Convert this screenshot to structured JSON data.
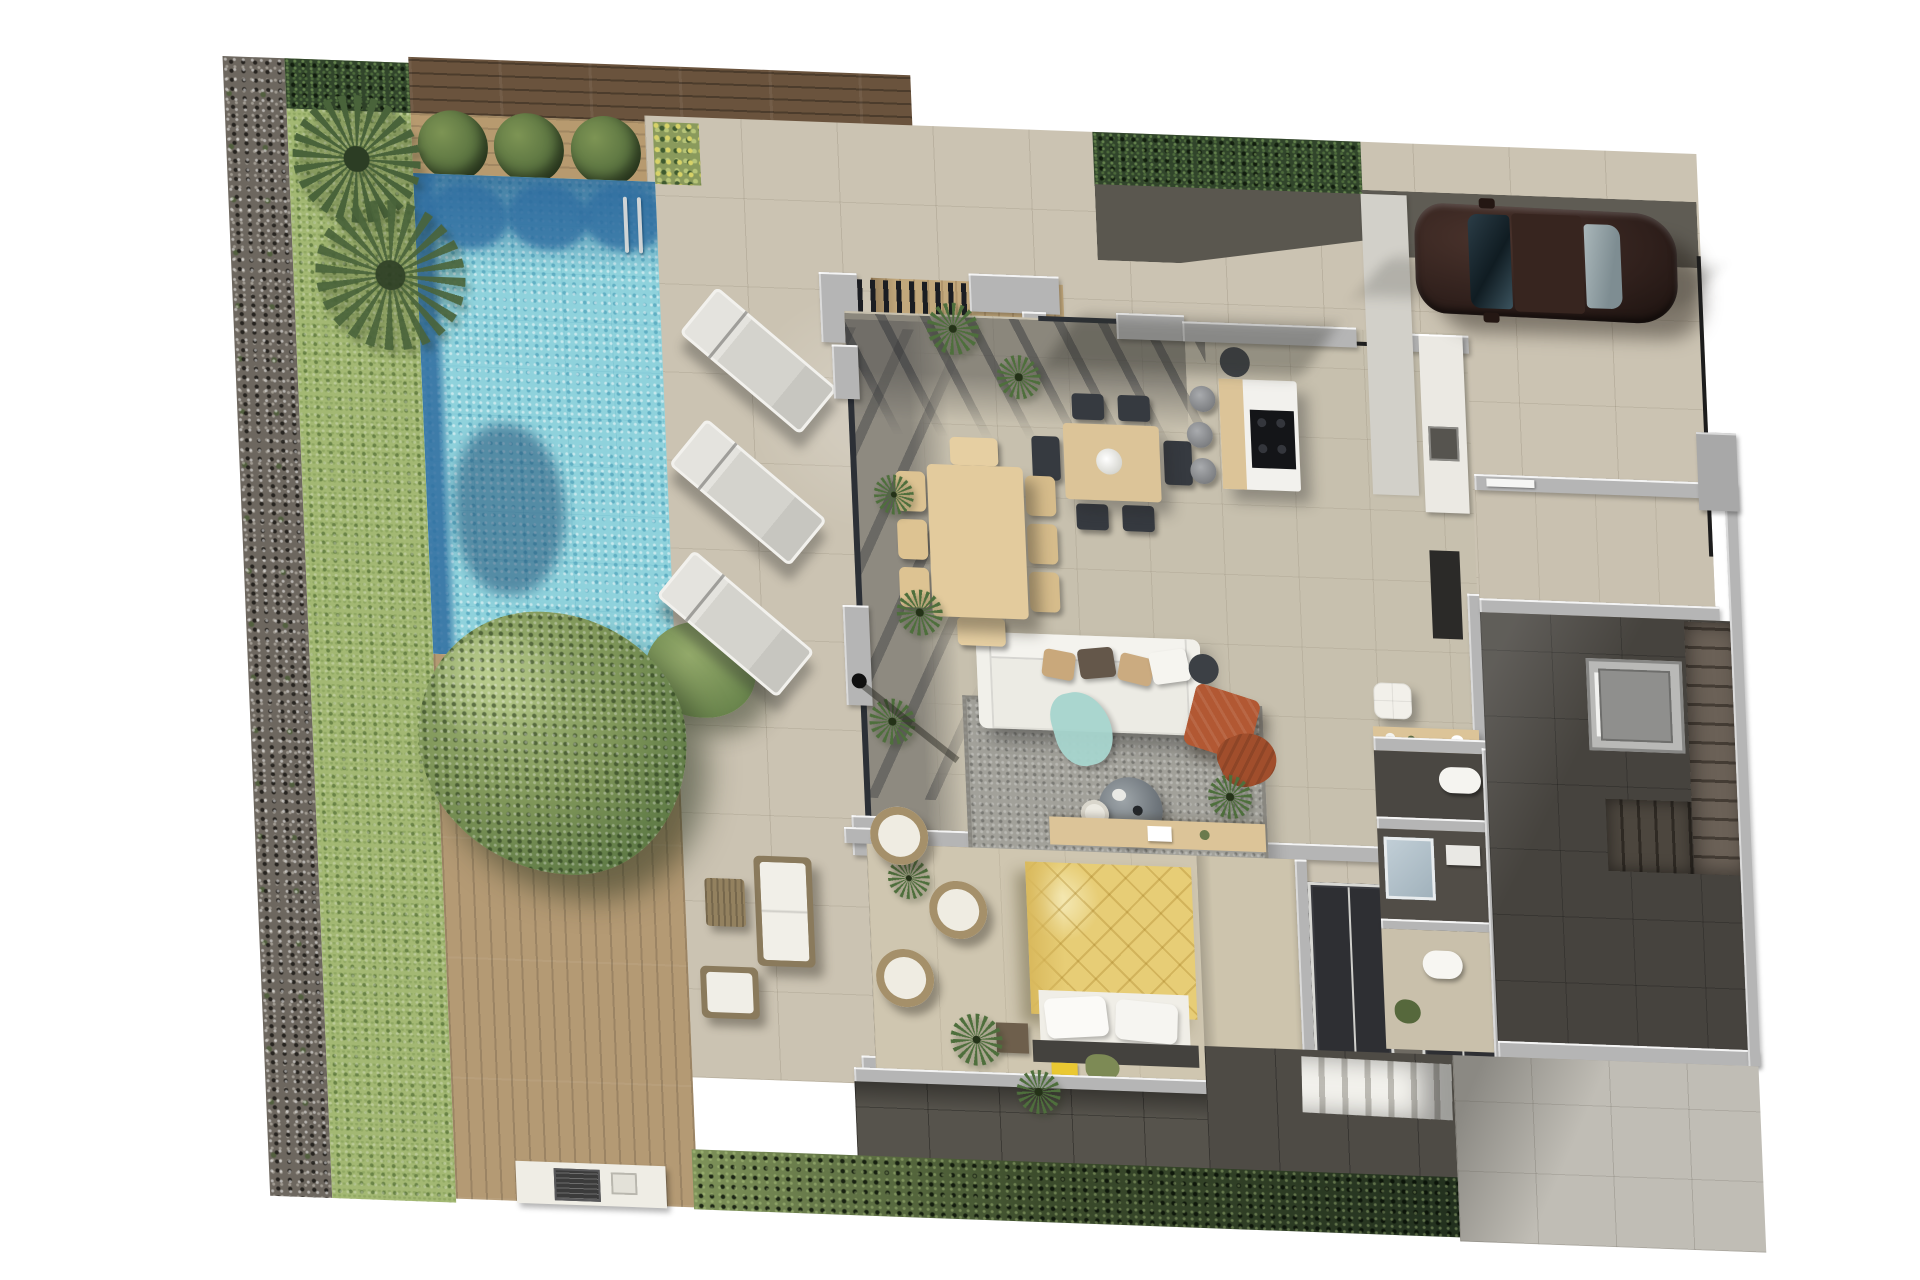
{
  "meta": {
    "title": "Villa ground-floor furnished plan - aerial 3D render",
    "view": "top-down orthographic render, plan tilted ~2deg",
    "has_visible_text": false
  },
  "palette": {
    "page-bg": "#ffffff",
    "gravel": "#6d675f",
    "grass": "#a3b873",
    "hedge-dark": "#31452b",
    "wood-dark": "#6a533d",
    "wood-mid": "#b79a6f",
    "wood-deck": "#b49a74",
    "wood-terrace": "#c2a87c",
    "pool-water": "#8fd2dc",
    "pool-shadow": "#2f6da0",
    "patio": "#cbc3b2",
    "paving": "#c0bdb5",
    "charcoal": "#56534c",
    "wall": "#b5b5b5",
    "wall-light": "#ebe9e3",
    "glass": "#2c3036",
    "slat": "#1b1d22",
    "floor-in": "#c7c0ae",
    "floor-dark": "#8e8a80",
    "table-wood": "#dcc498",
    "chair-dark": "#363a40",
    "counter": "#f2f1ed",
    "cooktop": "#141518",
    "sofa": "#ecebe4",
    "rug": "#a2a19a",
    "teal": "#a7d5ce",
    "orange": "#b25833",
    "bed-yellow": "#e7cd76",
    "bush": "#5a7340",
    "plant": "#49633a",
    "car": "#30201c"
  },
  "scene": {
    "garden": [
      "gravel-border",
      "lawn-strip",
      "palm-tree",
      "top-hedge",
      "boxwood-bushes-x3",
      "large-tree",
      "bottom-hedge",
      "flower-bed"
    ],
    "pool_zone": [
      "swimming-pool",
      "pool-ladder",
      "wooden-deck",
      "sun-loungers-x3",
      "barbecue-counter"
    ],
    "terrace": [
      "pergola",
      "outdoor-dining-table-6-chairs",
      "wicker-armchairs-x3",
      "potted-plants",
      "floor-lamp",
      "lounge-sofa-set",
      "lounge-coffee-table"
    ],
    "interior": [
      "living-room-sofa",
      "area-rug",
      "round-coffee-table",
      "orange-pouf",
      "indoor-dining-table-6-chairs",
      "kitchen-island-with-hob",
      "bar-stools-x3",
      "sideboard",
      "white-pouf",
      "desk-nook",
      "bedroom-double-bed-yellow",
      "wardrobes-x2",
      "corridor",
      "wc-room",
      "shower-room",
      "bathroom-with-toilet",
      "entry-hall",
      "elevator",
      "main-staircase",
      "exterior-staircase"
    ],
    "driveway": [
      "parked-car",
      "walkway",
      "entry-gate-box",
      "boundary-fence"
    ]
  }
}
